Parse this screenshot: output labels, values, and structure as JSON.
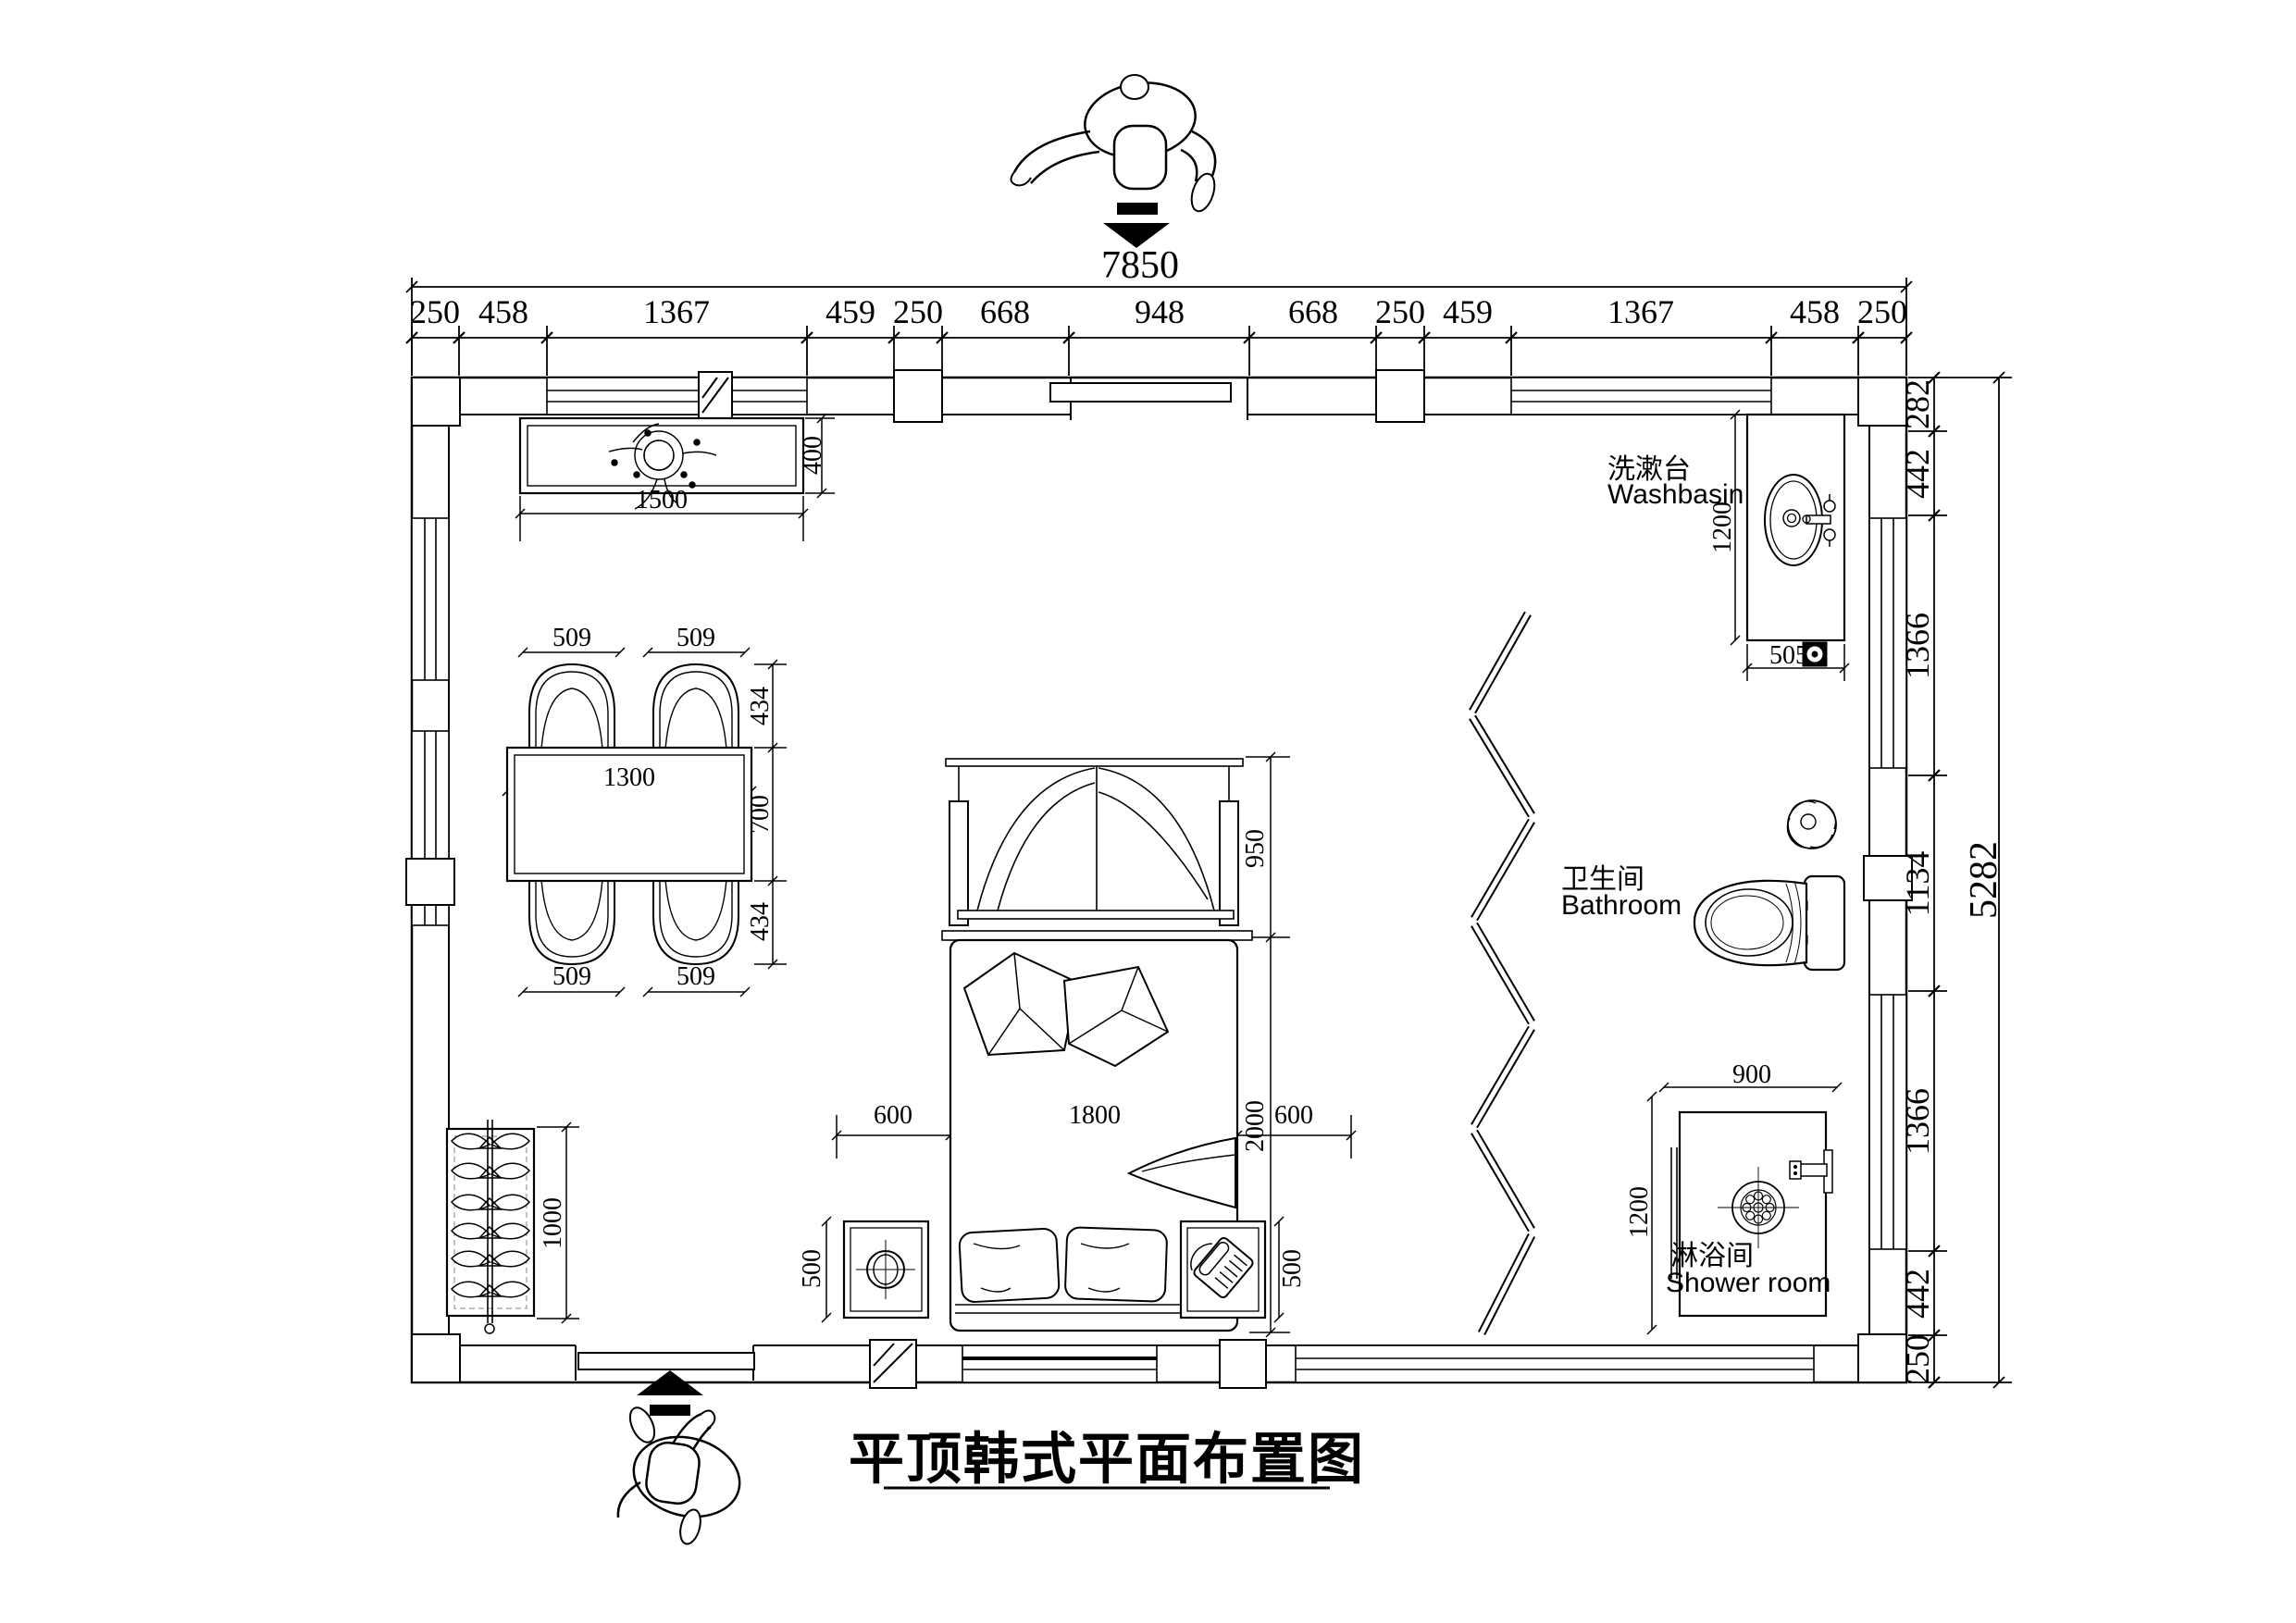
{
  "title": "平顶韩式平面布置图",
  "dim_chains": {
    "top_total": "7850",
    "top": [
      "250",
      "458",
      "1367",
      "459",
      "250",
      "668",
      "948",
      "668",
      "250",
      "459",
      "1367",
      "458",
      "250"
    ],
    "right_total": "5282",
    "right": [
      "282",
      "442",
      "1366",
      "1134",
      "1366",
      "442",
      "250"
    ]
  },
  "labels": {
    "washbasin_zh": "洗漱台",
    "washbasin_en": "Washbasin",
    "bathroom_zh": "卫生间",
    "bathroom_en": "Bathroom",
    "shower_zh": "淋浴间",
    "shower_en": "Shower room"
  },
  "furniture_dims": {
    "tv_cabinet_width": "1500",
    "tv_cabinet_depth": "400",
    "chair_top_left": "509",
    "chair_top_right": "509",
    "chair_bottom_left": "509",
    "chair_bottom_right": "509",
    "table_width": "1300",
    "chair_depth_top": "434",
    "table_depth": "700",
    "chair_depth_bottom": "434",
    "wardrobe_length": "1000",
    "bed_canopy_depth": "950",
    "bed_length": "2000",
    "bed_width": "1800",
    "bed_side_left": "600",
    "bed_side_right": "600",
    "nightstand_left": "500",
    "nightstand_right": "500",
    "washbasin_depth": "1200",
    "washbasin_width": "505",
    "shower_width": "900",
    "shower_depth": "1200"
  }
}
